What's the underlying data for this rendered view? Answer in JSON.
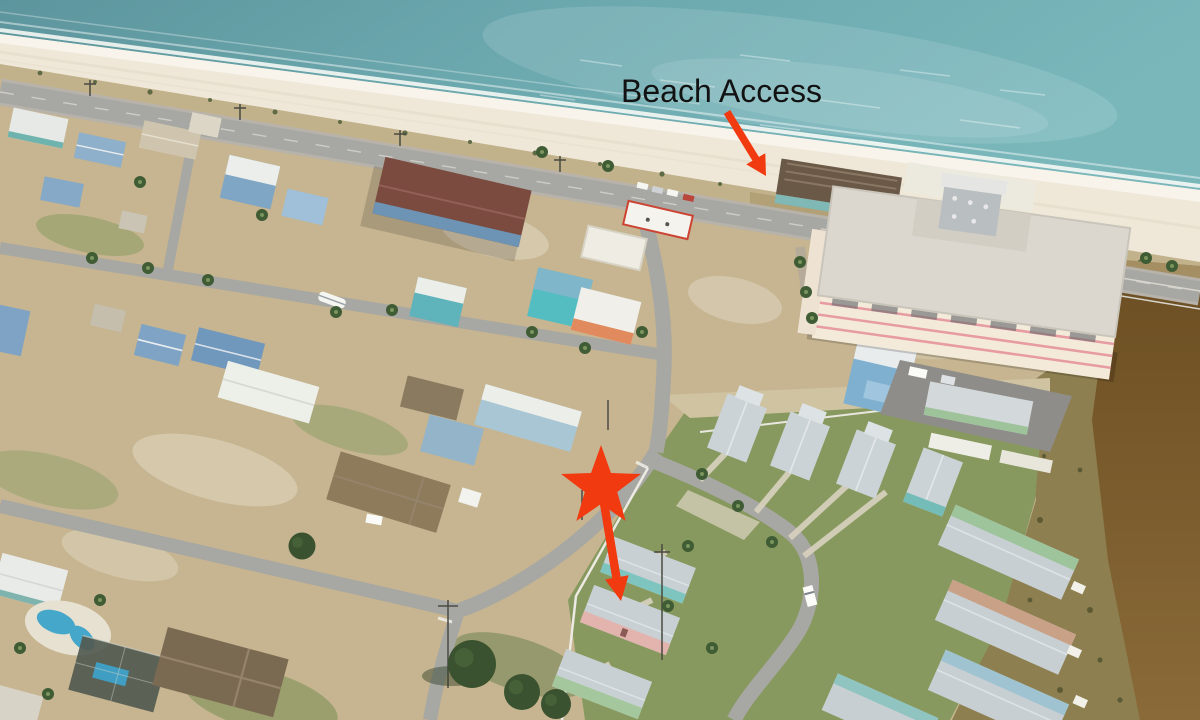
{
  "annotations": {
    "beach_access": {
      "label": "Beach Access",
      "text_color": "#121212"
    },
    "accent_color": "#f23a10"
  },
  "palette": {
    "ocean_deep": "#5d959d",
    "ocean_mid": "#6ba8ae",
    "ocean_bright": "#79b7bb",
    "sand": "#efe8d9",
    "dune": "#c2b28b",
    "land": "#c6b590",
    "road": "#a7a7a3",
    "grass": "#87995e",
    "channel_deep": "#6b4e22",
    "channel_light": "#8a6a38",
    "roof_metal": "#ccd3d6",
    "condo_wall": "#f3ead9",
    "condo_trim": "#e79ba2"
  }
}
